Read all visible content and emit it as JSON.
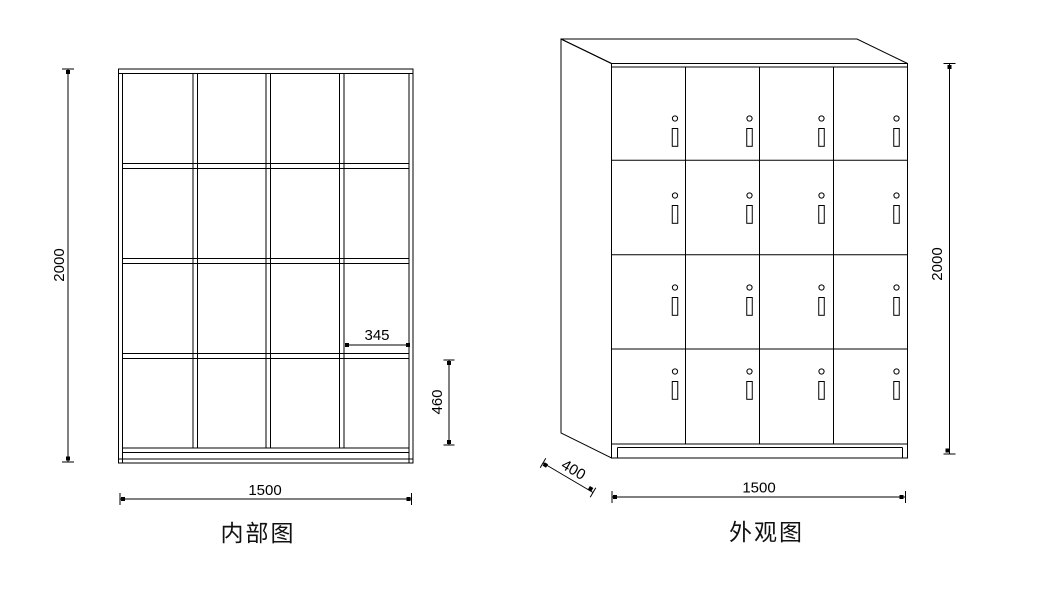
{
  "drawing": {
    "background": "#ffffff",
    "line_color": "#000000",
    "kind": "locker-cabinet-technical-drawing"
  },
  "internal_view": {
    "title": "内部图",
    "grid": {
      "rows": 4,
      "columns": 4
    },
    "dims": {
      "overall_height": "2000",
      "overall_width": "1500",
      "compartment_width": "345",
      "compartment_height": "460"
    }
  },
  "external_view": {
    "title": "外观图",
    "grid": {
      "rows": 4,
      "columns": 4
    },
    "door_hardware": {
      "keyhole_icon": "small-circle",
      "handle_icon": "vertical-slot"
    },
    "dims": {
      "overall_height": "2000",
      "overall_width": "1500",
      "depth": "400"
    }
  }
}
